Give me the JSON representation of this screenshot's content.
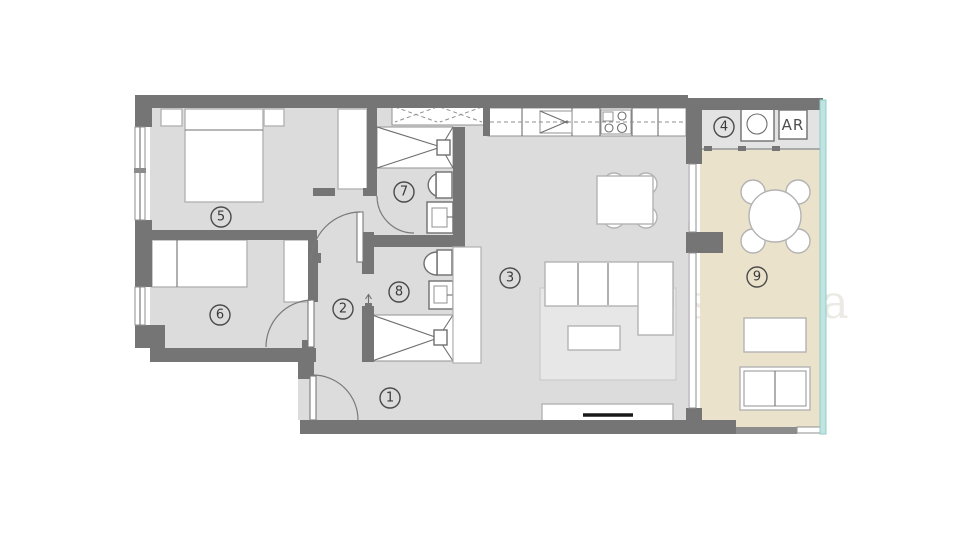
{
  "plan": {
    "type": "apartment-floor-plan",
    "watermark": {
      "text": "Mon Rêve España"
    },
    "colors": {
      "wall": "#757575",
      "interior_floor": "#dcdcdc",
      "terrace_floor": "#eae2cb",
      "laundry_floor": "#e3e3e3",
      "glass_balustrade": "#bfe4e1",
      "furniture_outline": "#b3b3b3",
      "label": "#3a3a3a",
      "tv": "#1a1a1a"
    },
    "rooms": [
      {
        "number": "1",
        "name": "entrance-hall"
      },
      {
        "number": "2",
        "name": "corridor"
      },
      {
        "number": "3",
        "name": "living-dining-kitchen"
      },
      {
        "number": "4",
        "name": "laundry"
      },
      {
        "number": "5",
        "name": "bedroom-1"
      },
      {
        "number": "6",
        "name": "bedroom-2"
      },
      {
        "number": "7",
        "name": "bathroom-1"
      },
      {
        "number": "8",
        "name": "bathroom-2"
      },
      {
        "number": "9",
        "name": "terrace"
      }
    ],
    "annotations": {
      "ar_label": "AR"
    }
  }
}
